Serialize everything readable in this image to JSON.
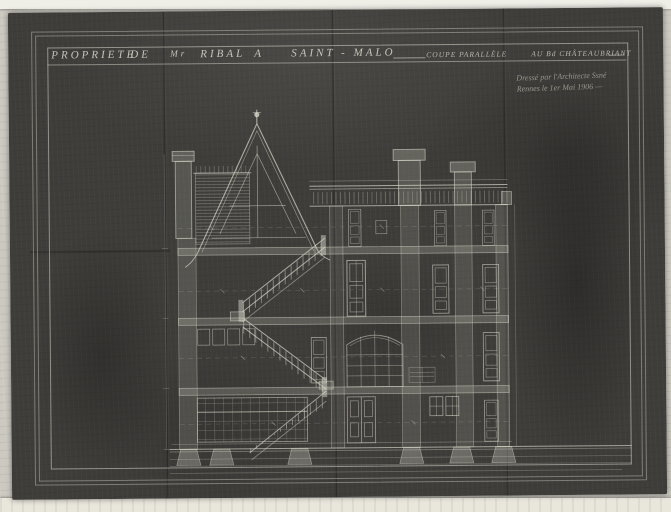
{
  "palette": {
    "photo_background": "#cbc9c0",
    "paper_edge": "#efeee7",
    "sheet": "#3e3d3a",
    "line": "#d8d6c8"
  },
  "title": {
    "words": [
      "PROPRIETE",
      "DE",
      "Mr",
      "RIBAL",
      "A",
      "SAINT - MALO"
    ],
    "subtitle_1": "COUPE PARALLÈLE",
    "subtitle_2": "AU Bd CHÂTEAUBRIANT"
  },
  "annotation": {
    "line1": "Dressé par l'Architecte Ssné",
    "line2": "Rennes le 1er Mai 1906 —"
  },
  "drawing": {
    "kind": "architectural cross-section of a town house",
    "elements": [
      "gable-roof",
      "finial",
      "chimney-stacks",
      "flat-roof-deck",
      "dog-leg-staircase",
      "floor-slabs",
      "panel-doors",
      "arched-window",
      "glazed-partitions",
      "foundation-piers",
      "ground-lines"
    ]
  }
}
